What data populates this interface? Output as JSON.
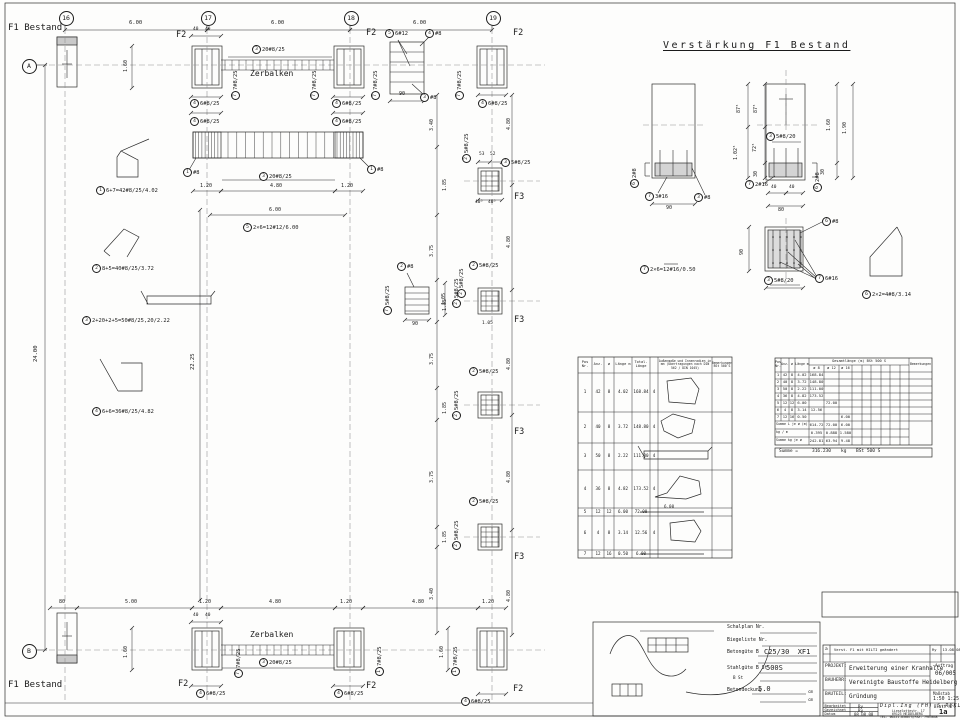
{
  "verstaerkung_title": "Verstärkung F1 Bestand",
  "notes": {
    "ok_fundamente": "OK Neue Fundamente -0.02m",
    "ankerplan1": "Siehe auch den Ankerplan",
    "ankerplan2": "der Fa.Stahlbau Alfred Müller GmbH !",
    "boden1": "Alle Fundamente auf gewachsenem Boden Gründen.",
    "boden2": "Übertiefen mit dem Magerbeton ausgleichen.",
    "sauberkeit": "Unter allen Fundamenten Sauberkeitsschicht 5.0cm einbauen!",
    "bodenpressung": "Zulässige Bodenpressung < 200kN/m2",
    "hilti": "Hilti HIT HY150 #16",
    "hilti_depth": "50"
  },
  "grid_bubbles": [
    {
      "x": 65,
      "y": 17,
      "t": "16"
    },
    {
      "x": 207,
      "y": 17,
      "t": "17"
    },
    {
      "x": 350,
      "y": 17,
      "t": "18"
    },
    {
      "x": 492,
      "y": 17,
      "t": "19"
    },
    {
      "x": 28,
      "y": 65,
      "t": "A"
    },
    {
      "x": 28,
      "y": 650,
      "t": "B"
    }
  ],
  "annotations": [
    {
      "x": 8,
      "y": 24,
      "t": "F1 Bestand",
      "s": 9,
      "n": "label-f1-bestand-top"
    },
    {
      "x": 8,
      "y": 681,
      "t": "F1 Bestand",
      "s": 9,
      "n": "label-f1-bestand-bottom"
    },
    {
      "x": 663,
      "y": 41,
      "t": "Verstärkung F1 Bestand",
      "s": 10,
      "ls": 2.5,
      "u": 1,
      "n": "verstaerkung-title"
    },
    {
      "x": 129,
      "y": 21,
      "t": "6.00",
      "s": 5.5,
      "n": "dim-grid"
    },
    {
      "x": 271,
      "y": 21,
      "t": "6.00",
      "s": 5.5,
      "n": "dim-grid"
    },
    {
      "x": 413,
      "y": 21,
      "t": "6.00",
      "s": 5.5,
      "n": "dim-grid"
    },
    {
      "x": 176,
      "y": 31,
      "t": "F2",
      "s": 8.5,
      "n": "label-f2"
    },
    {
      "x": 366,
      "y": 29,
      "t": "F2",
      "s": 8.5,
      "n": "label-f2"
    },
    {
      "x": 513,
      "y": 29,
      "t": "F2",
      "s": 8.5,
      "n": "label-f2"
    },
    {
      "x": 178,
      "y": 680,
      "t": "F2",
      "s": 8.5,
      "n": "label-f2"
    },
    {
      "x": 366,
      "y": 682,
      "t": "F2",
      "s": 8.5,
      "n": "label-f2"
    },
    {
      "x": 513,
      "y": 685,
      "t": "F2",
      "s": 8.5,
      "n": "label-f2"
    },
    {
      "x": 514,
      "y": 193,
      "t": "F3",
      "s": 8.5,
      "n": "label-f3"
    },
    {
      "x": 514,
      "y": 316,
      "t": "F3",
      "s": 8.5,
      "n": "label-f3"
    },
    {
      "x": 514,
      "y": 428,
      "t": "F3",
      "s": 8.5,
      "n": "label-f3"
    },
    {
      "x": 514,
      "y": 553,
      "t": "F3",
      "s": 8.5,
      "n": "label-f3"
    },
    {
      "x": 250,
      "y": 70,
      "t": "Zerbalken",
      "s": 8,
      "n": "label-zerbalken-top"
    },
    {
      "x": 250,
      "y": 631,
      "t": "Zerbalken",
      "s": 8,
      "n": "label-zerbalken-bottom"
    },
    {
      "x": 200,
      "y": 184,
      "t": "1.20",
      "s": 5,
      "n": "dim"
    },
    {
      "x": 270,
      "y": 184,
      "t": "4.80",
      "s": 5,
      "n": "dim"
    },
    {
      "x": 341,
      "y": 184,
      "t": "1.20",
      "s": 5,
      "n": "dim"
    },
    {
      "x": 269,
      "y": 208,
      "t": "6.00",
      "s": 5,
      "n": "dim"
    },
    {
      "x": 59,
      "y": 600,
      "t": "80",
      "s": 5,
      "n": "dim"
    },
    {
      "x": 125,
      "y": 600,
      "t": "5.00",
      "s": 5,
      "n": "dim"
    },
    {
      "x": 199,
      "y": 600,
      "t": "1.20",
      "s": 5,
      "n": "dim"
    },
    {
      "x": 269,
      "y": 600,
      "t": "4.80",
      "s": 5,
      "n": "dim"
    },
    {
      "x": 340,
      "y": 600,
      "t": "1.20",
      "s": 5,
      "n": "dim"
    },
    {
      "x": 412,
      "y": 600,
      "t": "4.80",
      "s": 5,
      "n": "dim"
    },
    {
      "x": 482,
      "y": 600,
      "t": "1.20",
      "s": 5,
      "n": "dim"
    },
    {
      "x": 34,
      "y": 362,
      "t": "24.00",
      "s": 5.5,
      "r": 1,
      "n": "dim-24"
    },
    {
      "x": 191,
      "y": 370,
      "t": "22.25",
      "s": 5.5,
      "r": 1,
      "n": "dim-2225"
    },
    {
      "x": 124,
      "y": 72,
      "t": "1.60",
      "s": 5,
      "r": 1,
      "n": "dim"
    },
    {
      "x": 124,
      "y": 658,
      "t": "1.60",
      "s": 5,
      "r": 1,
      "n": "dim"
    },
    {
      "x": 440,
      "y": 658,
      "t": "1.60",
      "s": 5,
      "r": 1,
      "n": "dim"
    },
    {
      "x": 430,
      "y": 131,
      "t": "3.40",
      "s": 5,
      "r": 1,
      "n": "dim"
    },
    {
      "x": 443,
      "y": 191,
      "t": "1.85",
      "s": 5,
      "r": 1,
      "n": "dim"
    },
    {
      "x": 430,
      "y": 257,
      "t": "3.75",
      "s": 5,
      "r": 1,
      "n": "dim"
    },
    {
      "x": 443,
      "y": 311,
      "t": "1.85",
      "s": 5,
      "r": 1,
      "n": "dim"
    },
    {
      "x": 430,
      "y": 365,
      "t": "3.75",
      "s": 5,
      "r": 1,
      "n": "dim"
    },
    {
      "x": 443,
      "y": 414,
      "t": "1.85",
      "s": 5,
      "r": 1,
      "n": "dim"
    },
    {
      "x": 430,
      "y": 483,
      "t": "3.75",
      "s": 5,
      "r": 1,
      "n": "dim"
    },
    {
      "x": 443,
      "y": 543,
      "t": "1.85",
      "s": 5,
      "r": 1,
      "n": "dim"
    },
    {
      "x": 430,
      "y": 600,
      "t": "3.40",
      "s": 5,
      "r": 1,
      "n": "dim"
    },
    {
      "x": 507,
      "y": 130,
      "t": "4.80",
      "s": 5,
      "r": 1,
      "n": "dim"
    },
    {
      "x": 507,
      "y": 248,
      "t": "4.80",
      "s": 5,
      "r": 1,
      "n": "dim"
    },
    {
      "x": 507,
      "y": 370,
      "t": "4.80",
      "s": 5,
      "r": 1,
      "n": "dim"
    },
    {
      "x": 507,
      "y": 483,
      "t": "4.80",
      "s": 5,
      "r": 1,
      "n": "dim"
    },
    {
      "x": 507,
      "y": 602,
      "t": "4.80",
      "s": 5,
      "r": 1,
      "n": "dim"
    },
    {
      "x": 442,
      "y": 305,
      "t": "1.05",
      "s": 5,
      "r": 1,
      "n": "dim"
    },
    {
      "x": 479,
      "y": 153,
      "t": "53",
      "s": 4.5,
      "n": "dim"
    },
    {
      "x": 490,
      "y": 153,
      "t": "52",
      "s": 4.5,
      "n": "dim"
    },
    {
      "x": 475,
      "y": 201,
      "t": "40⁵",
      "s": 4.5,
      "n": "dim"
    },
    {
      "x": 488,
      "y": 201,
      "t": "40⁵",
      "s": 4.5,
      "n": "dim"
    },
    {
      "x": 482,
      "y": 322,
      "t": "1.05",
      "s": 4.5,
      "n": "dim"
    },
    {
      "x": 399,
      "y": 92,
      "t": "90",
      "s": 5,
      "n": "dim"
    },
    {
      "x": 412,
      "y": 322,
      "t": "90",
      "s": 5,
      "n": "dim"
    },
    {
      "x": 193,
      "y": 28,
      "t": "40",
      "s": 4.5,
      "n": "dim"
    },
    {
      "x": 205,
      "y": 28,
      "t": "40",
      "s": 4.5,
      "n": "dim"
    },
    {
      "x": 193,
      "y": 614,
      "t": "40",
      "s": 4.5,
      "n": "dim"
    },
    {
      "x": 205,
      "y": 614,
      "t": "40",
      "s": 4.5,
      "n": "dim"
    },
    {
      "x": 737,
      "y": 113,
      "t": "87⁵",
      "s": 5,
      "r": 1,
      "n": "dim"
    },
    {
      "x": 734,
      "y": 160,
      "t": "1.02⁵",
      "s": 5,
      "r": 1,
      "n": "dim"
    },
    {
      "x": 754,
      "y": 113,
      "t": "87⁵",
      "s": 5,
      "r": 1,
      "n": "dim"
    },
    {
      "x": 753,
      "y": 152,
      "t": "72⁵",
      "s": 5,
      "r": 1,
      "n": "dim"
    },
    {
      "x": 754,
      "y": 177,
      "t": "30",
      "s": 5,
      "r": 1,
      "n": "dim"
    },
    {
      "x": 827,
      "y": 131,
      "t": "1.60",
      "s": 5,
      "r": 1,
      "n": "dim"
    },
    {
      "x": 843,
      "y": 134,
      "t": "1.90",
      "s": 5,
      "r": 1,
      "n": "dim"
    },
    {
      "x": 821,
      "y": 175,
      "t": "30",
      "s": 5,
      "r": 1,
      "n": "dim"
    },
    {
      "x": 666,
      "y": 206,
      "t": "90",
      "s": 5,
      "n": "dim"
    },
    {
      "x": 771,
      "y": 186,
      "t": "40",
      "s": 4.5,
      "n": "dim"
    },
    {
      "x": 789,
      "y": 186,
      "t": "40",
      "s": 4.5,
      "n": "dim"
    },
    {
      "x": 778,
      "y": 208,
      "t": "80",
      "s": 5,
      "n": "dim"
    },
    {
      "x": 740,
      "y": 255,
      "t": "90",
      "s": 5,
      "r": 1,
      "n": "dim"
    },
    {
      "x": 664,
      "y": 505,
      "t": "6.00",
      "s": 4.2,
      "n": "dim-shape"
    },
    {
      "x": 779,
      "y": 449.5,
      "t": "Summe =",
      "s": 4.5,
      "n": "summe-label"
    },
    {
      "x": 812,
      "y": 449.5,
      "t": "316.230",
      "s": 4.5,
      "n": "summe-value"
    },
    {
      "x": 841,
      "y": 449.5,
      "t": "kg",
      "s": 4.5,
      "n": "summe-unit"
    },
    {
      "x": 856,
      "y": 449.5,
      "t": "BSt 500 S",
      "s": 4.5,
      "n": "summe-grade"
    }
  ],
  "callouts": [
    {
      "x": 252,
      "y": 45,
      "n": "3",
      "t": "20#8/25"
    },
    {
      "x": 190,
      "y": 99,
      "n": "4",
      "t": "6#8/25"
    },
    {
      "x": 332,
      "y": 99,
      "n": "4",
      "t": "6#8/25"
    },
    {
      "x": 190,
      "y": 117,
      "n": "4",
      "t": "6#8/25"
    },
    {
      "x": 332,
      "y": 117,
      "n": "4",
      "t": "6#8/25"
    },
    {
      "x": 478,
      "y": 99,
      "n": "4",
      "t": "6#8/25"
    },
    {
      "x": 231,
      "y": 100,
      "n": "7",
      "t": "7#8/25",
      "r": 1
    },
    {
      "x": 310,
      "y": 100,
      "n": "7",
      "t": "7#8/25",
      "r": 1
    },
    {
      "x": 371,
      "y": 100,
      "n": "7",
      "t": "7#8/25",
      "r": 1
    },
    {
      "x": 455,
      "y": 100,
      "n": "7",
      "t": "7#8/25",
      "r": 1
    },
    {
      "x": 183,
      "y": 168,
      "n": "1",
      "t": "#8"
    },
    {
      "x": 367,
      "y": 165,
      "n": "1",
      "t": "#8"
    },
    {
      "x": 259,
      "y": 172,
      "n": "3",
      "t": "20#8/25"
    },
    {
      "x": 243,
      "y": 223,
      "n": "5",
      "t": "2×6=12#12/6.00"
    },
    {
      "x": 385,
      "y": 29,
      "n": "5",
      "t": "6#12"
    },
    {
      "x": 425,
      "y": 29,
      "n": "4",
      "t": "#8"
    },
    {
      "x": 420,
      "y": 93,
      "n": "3",
      "t": "#8"
    },
    {
      "x": 462,
      "y": 163,
      "n": "2",
      "t": "5#8/25",
      "r": 1
    },
    {
      "x": 501,
      "y": 158,
      "n": "3",
      "t": "5#8/25"
    },
    {
      "x": 469,
      "y": 261,
      "n": "2",
      "t": "5#8/25"
    },
    {
      "x": 452,
      "y": 308,
      "n": "2",
      "t": "5#8/25",
      "r": 1
    },
    {
      "x": 397,
      "y": 262,
      "n": "2",
      "t": "#8"
    },
    {
      "x": 383,
      "y": 315,
      "n": "7",
      "t": "5#8/25",
      "r": 1
    },
    {
      "x": 457,
      "y": 298,
      "n": "2",
      "t": "5#8/25",
      "r": 1
    },
    {
      "x": 469,
      "y": 367,
      "n": "2",
      "t": "5#8/25"
    },
    {
      "x": 452,
      "y": 420,
      "n": "2",
      "t": "5#8/25",
      "r": 1
    },
    {
      "x": 469,
      "y": 497,
      "n": "2",
      "t": "5#8/25"
    },
    {
      "x": 452,
      "y": 550,
      "n": "2",
      "t": "5#8/25",
      "r": 1
    },
    {
      "x": 96,
      "y": 186,
      "n": "1",
      "t": "6+7=42#8/25/4.02"
    },
    {
      "x": 92,
      "y": 264,
      "n": "2",
      "t": "8+5=40#8/25/3.72"
    },
    {
      "x": 82,
      "y": 316,
      "n": "3",
      "t": "2+20+2+5=50#8/25,20/2.22"
    },
    {
      "x": 92,
      "y": 407,
      "n": "4",
      "t": "6+6=36#8/25/4.82"
    },
    {
      "x": 259,
      "y": 658,
      "n": "3",
      "t": "20#8/25"
    },
    {
      "x": 196,
      "y": 689,
      "n": "4",
      "t": "6#8/25"
    },
    {
      "x": 334,
      "y": 689,
      "n": "4",
      "t": "6#8/25"
    },
    {
      "x": 461,
      "y": 697,
      "n": "4",
      "t": "6#8/25"
    },
    {
      "x": 234,
      "y": 678,
      "n": "7",
      "t": "7#8/25",
      "r": 1
    },
    {
      "x": 375,
      "y": 676,
      "n": "1",
      "t": "7#8/25",
      "r": 1
    },
    {
      "x": 451,
      "y": 676,
      "n": "1",
      "t": "7#8/25",
      "r": 1
    },
    {
      "x": 630,
      "y": 188,
      "n": "6",
      "t": "2#8",
      "r": 1
    },
    {
      "x": 645,
      "y": 192,
      "n": "7",
      "t": "3#16"
    },
    {
      "x": 694,
      "y": 193,
      "n": "3",
      "t": "#8"
    },
    {
      "x": 766,
      "y": 132,
      "n": "3",
      "t": "5#8/20"
    },
    {
      "x": 745,
      "y": 180,
      "n": "7",
      "t": "2#16"
    },
    {
      "x": 813,
      "y": 192,
      "n": "6",
      "t": "2#8",
      "r": 1
    },
    {
      "x": 822,
      "y": 217,
      "n": "6",
      "t": "#8"
    },
    {
      "x": 815,
      "y": 274,
      "n": "7",
      "t": "6#16"
    },
    {
      "x": 764,
      "y": 276,
      "n": "3",
      "t": "5#8/20"
    },
    {
      "x": 640,
      "y": 265,
      "n": "7",
      "t": "2×6=12#16/0.50"
    },
    {
      "x": 862,
      "y": 290,
      "n": "6",
      "t": "2×2=4#8/3.14"
    }
  ],
  "table1": {
    "col_headers": [
      "Pos Nr.",
      "Anz.",
      "ø",
      "Länge m",
      "Total- Länge",
      "",
      "Außenmaße und Innenradien in mm (Übertragungen nach DIN 562 / DIN 1045)",
      "Bemerkungen BSt 500 S"
    ],
    "rows": [
      [
        "1",
        "42",
        "8",
        "4.02",
        "168.84",
        "4"
      ],
      [
        "2",
        "40",
        "8",
        "3.72",
        "148.80",
        "4"
      ],
      [
        "3",
        "50",
        "8",
        "2.22",
        "111.00",
        "4"
      ],
      [
        "4",
        "36",
        "8",
        "4.82",
        "173.52",
        "4"
      ],
      [
        "5",
        "12",
        "12",
        "6.00",
        "72.00",
        ""
      ],
      [
        "6",
        "4",
        "8",
        "3.14",
        "12.56",
        "4"
      ],
      [
        "7",
        "12",
        "16",
        "0.50",
        "6.00",
        ""
      ]
    ]
  },
  "table2": {
    "col_headers": [
      "Pos Nr.",
      "Anz.",
      "ø",
      "Länge m"
    ],
    "group_header": "Gesamtlänge (m)  BSt 500 S",
    "sub_headers": [
      "ø 8",
      "ø 12",
      "ø 16"
    ],
    "bem_header": "Bemerkungen",
    "rows": [
      [
        "1",
        "42",
        "8",
        "4.02",
        "168.84",
        "",
        ""
      ],
      [
        "2",
        "40",
        "8",
        "3.72",
        "148.80",
        "",
        ""
      ],
      [
        "3",
        "50",
        "8",
        "2.22",
        "111.00",
        "",
        ""
      ],
      [
        "4",
        "36",
        "8",
        "4.82",
        "173.52",
        "",
        ""
      ],
      [
        "5",
        "12",
        "12",
        "6.00",
        "",
        "72.00",
        ""
      ],
      [
        "6",
        "4",
        "8",
        "3.14",
        "12.56",
        "",
        ""
      ],
      [
        "7",
        "12",
        "16",
        "0.50",
        "",
        "",
        "6.00"
      ]
    ],
    "sum_len_label": "Summe L je ø (m)",
    "sum_len": [
      "614.72",
      "72.00",
      "6.00"
    ],
    "kgm_label": "kg / m",
    "kgm": [
      "0.395",
      "0.888",
      "1.580"
    ],
    "sum_kg_label": "Summe kg je ø",
    "sum_kg": [
      "242.81",
      "63.94",
      "9.48"
    ]
  },
  "stamp": {
    "schalplan_label": "Schalplan Nr.",
    "biegeliste_label": "Biegeliste Nr.",
    "betonguete_label": "Betongüte B",
    "betonguete": "C25/30  XF1",
    "stahlguete_label": "Stahlgüte B St",
    "bst_label": "B St",
    "stahlguete": "500S",
    "betondeckung_label": "Betondeckung",
    "betondeckung": "5.0",
    "cm1": "cm",
    "cm2": "cm"
  },
  "title_block": {
    "revision": {
      "mark": "a",
      "text": "Verst. F1 mit HILTI geändert",
      "by": "Ry",
      "date": "13.08.08"
    },
    "projekt_label": "PROJEKT:",
    "projekt": "Erweiterung einer Kranhalle",
    "auftrag_label": "Auftrag",
    "auftrag": "06/005",
    "bauherr_label": "BAUHERR:",
    "bauherr": "Vereinigte Baustoffe Heidelberg",
    "bauteil_label": "BAUTEIL:",
    "bauteil": "Gründung",
    "massstab_label": "Maßstab",
    "massstab": "1:50 1:25",
    "bearb_label": "Bearbeitet",
    "bearb": "Ry",
    "gez_label": "Gezeichnet",
    "gez": "Ry",
    "datum_label": "Datum",
    "datum": "08.08.08",
    "firm": "Dipl.Ing (FH) S.RYKLIN",
    "addr1": "Lieselottestr. 17",
    "addr2": "69123 HEIDELBERG",
    "addr3": "TEL: 06221-830673/FAX: 7963048",
    "blatt_label": "Blatt Nr.",
    "blatt": "1a"
  }
}
